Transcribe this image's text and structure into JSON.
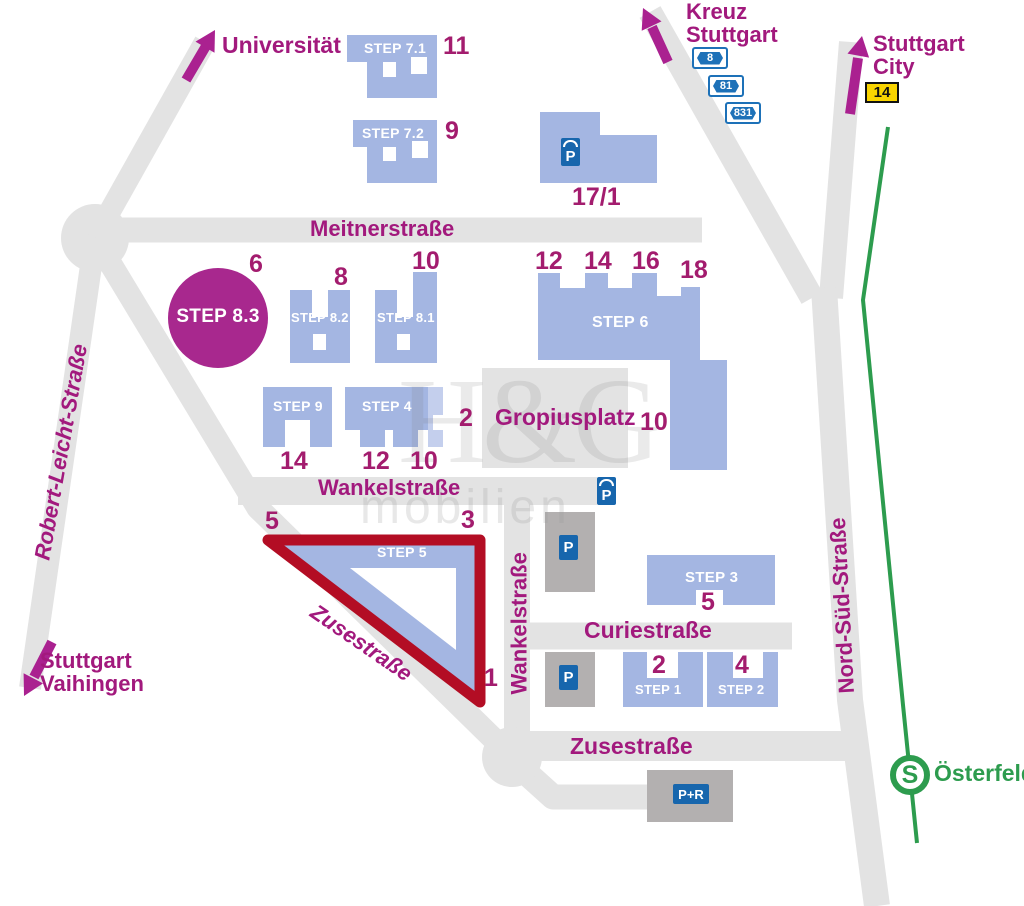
{
  "map": {
    "title": "STEP Stuttgarter Engineering Park site map",
    "destinations": {
      "universitaet": "Universität",
      "kreuz": {
        "line1": "Kreuz",
        "line2": "Stuttgart"
      },
      "city": {
        "line1": "Stuttgart",
        "line2": "City"
      },
      "vaihingen": {
        "line1": "Stuttgart",
        "line2": "Vaihingen"
      }
    },
    "streets": {
      "meitnerstrasse": "Meitnerstraße",
      "robert_leicht_strasse": "Robert-Leicht-Straße",
      "wankelstrasse": "Wankelstraße",
      "curiestrasse": "Curiestraße",
      "zusestrasse": "Zusestraße",
      "nord_sued_strasse": "Nord-Süd-Straße",
      "gropiusplatz": "Gropiusplatz"
    },
    "buildings": {
      "step71": {
        "name": "STEP 7.1",
        "number": "11"
      },
      "step72": {
        "name": "STEP 7.2",
        "number": "9"
      },
      "b17_1": {
        "number": "17/1"
      },
      "step83": {
        "name": "STEP 8.3",
        "number": "6"
      },
      "step82": {
        "name": "STEP 8.2",
        "number": "8"
      },
      "step81": {
        "name": "STEP 8.1",
        "number": "10"
      },
      "step9": {
        "name": "STEP 9",
        "number": "14"
      },
      "step4": {
        "name": "STEP 4",
        "number_left": "12",
        "number_right": "10",
        "number_east": "2"
      },
      "step6": {
        "name": "STEP 6",
        "entrance_numbers": [
          "12",
          "14",
          "16",
          "18"
        ],
        "number_south": "10"
      },
      "step5": {
        "name": "STEP 5",
        "corner_nw": "5",
        "corner_ne": "3",
        "corner_se": "1"
      },
      "step3": {
        "name": "STEP 3",
        "number": "5"
      },
      "step1": {
        "name": "STEP 1",
        "number": "2"
      },
      "step2": {
        "name": "STEP 2",
        "number": "4"
      }
    },
    "transit": {
      "bus_lines": [
        "8",
        "81",
        "831"
      ],
      "tram_line": "14",
      "sbahn_letter": "S",
      "sbahn_station": "Österfeld"
    },
    "parking": {
      "p": "P",
      "pr": "P+R"
    },
    "watermark": {
      "monogram": "H&G",
      "word": "mobilien"
    },
    "colors": {
      "magenta_label": "#a2197d",
      "magenta_number": "#a31c6e",
      "arrow_magenta": "#aa2190",
      "building_blue": "#a4b6e2",
      "building_blue_light": "#c4cfed",
      "circle_magenta": "#a8288e",
      "step5_outline_red": "#b30d24",
      "road_gray": "#e3e3e3",
      "parking_gray": "#b3b0b0",
      "parking_blue": "#1766ad",
      "bus_blue": "#1d71b8",
      "tram_yellow": "#f9d400",
      "sbahn_green": "#2d9c4e"
    }
  }
}
